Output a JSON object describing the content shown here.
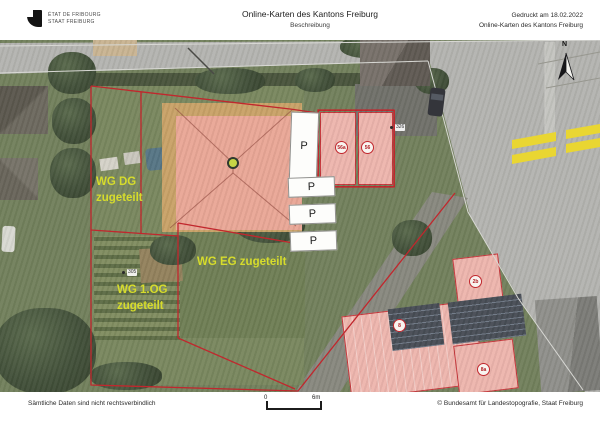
{
  "header": {
    "logo_line1": "ÉTAT DE FRIBOURG",
    "logo_line2": "STAAT FREIBURG",
    "title": "Online-Karten des Kantons Freiburg",
    "subtitle": "Beschreibung",
    "printed_at": "Gedruckt am 18.02.2022",
    "source_name": "Online-Karten des Kantons Freiburg"
  },
  "map": {
    "north_label": "N",
    "labels": {
      "wg_dg_line1": "WG DG",
      "wg_dg_line2": "zugeteilt",
      "wg_eg": "WG EG zugeteilt",
      "wg_og_line1": "WG 1.OG",
      "wg_og_line2": "zugeteilt"
    },
    "parking_labels": [
      "P",
      "P",
      "P",
      "P"
    ],
    "building_numbers": [
      "56a",
      "56",
      "2b",
      "8",
      "8a"
    ],
    "parcel_numbers": [
      "305",
      "326"
    ],
    "colors": {
      "assignment_text": "#d6dc2c",
      "boundary_red": "#c1272d",
      "building_pink": "#eeb5ae",
      "crosswalk_yellow": "#e9d632"
    }
  },
  "footer": {
    "disclaimer": "Sämtliche Daten sind nicht rechtsverbindlich",
    "scale_start": "0",
    "scale_end": "6m",
    "copyright": "© Bundesamt für Landestopografie, Staat Freiburg"
  }
}
